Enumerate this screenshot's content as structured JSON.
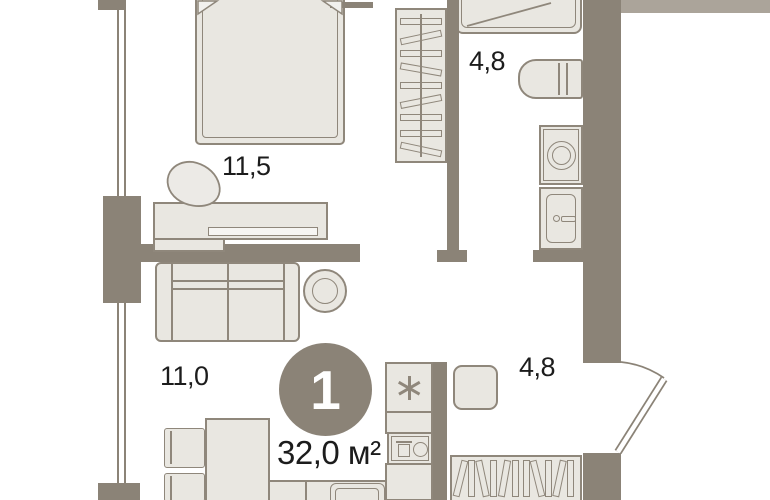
{
  "floor_plan": {
    "unit": {
      "rooms_count": "1",
      "total_area": "32,0 м²"
    },
    "rooms": {
      "bedroom": {
        "name": "bedroom",
        "area": "11,5"
      },
      "living": {
        "name": "living-room",
        "area": "11,0"
      },
      "bathroom": {
        "name": "bathroom",
        "area": "4,8"
      },
      "hallway": {
        "name": "hallway",
        "area": "4,8"
      }
    },
    "icons": {
      "fridge_symbol": "six-spoke-asterisk",
      "entry_door": "door-leaf-with-quarter-arc-swing",
      "shower": "square-tray-with-diagonal",
      "window": "double-line-on-left-wall",
      "wardrobes": "hanger-slat-pattern"
    },
    "colors": {
      "wall": "#8b8377",
      "furniture_fill": "#e9e7e1",
      "furniture_outline": "#8f877b",
      "background": "#ffffff",
      "label_text": "#1c1c1c",
      "badge_fill": "#8b8377",
      "badge_text": "#ffffff",
      "neighbor_wall": "#aba49a"
    }
  }
}
